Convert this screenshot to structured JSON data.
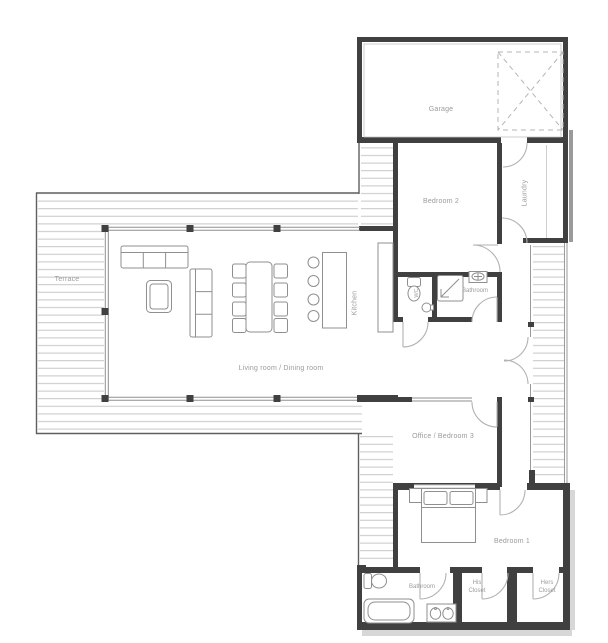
{
  "plan": {
    "rooms": {
      "terrace": "Terrace",
      "garage": "Garage",
      "bedroom2": "Bedroom 2",
      "laundry": "Laundry",
      "kitchen": "Kitchen",
      "wc": "WC",
      "bathroom_small": "Bathroom",
      "living_dining": "Living room / Dining room",
      "office_bedroom3": "Office / Bedroom 3",
      "bedroom1": "Bedroom 1",
      "bathroom_master": "Bathroom",
      "his_closet_line1": "His",
      "his_closet_line2": "Closet",
      "hers_closet_line1": "Hers",
      "hers_closet_line2": "Closet"
    },
    "colors": {
      "background": "#ffffff",
      "wall": "#404040",
      "window_line": "#8f8f8f",
      "hatch_line": "#c7c7c7",
      "door_arc": "#b2b2b2",
      "label": "#9b9b9b",
      "furniture": "#8f8f8f",
      "dashed": "#b5b5b5",
      "shadow": "#d7d7d7"
    }
  }
}
